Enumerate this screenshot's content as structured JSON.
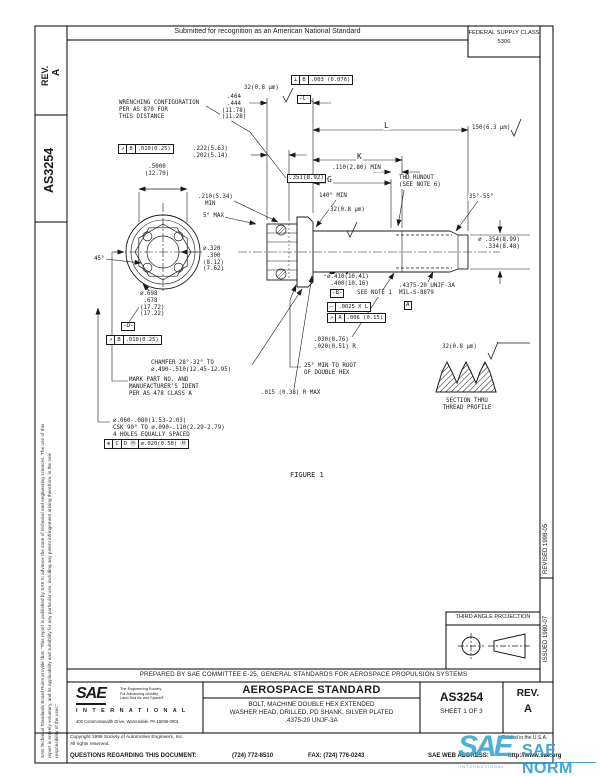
{
  "header": {
    "submitted": "Submitted for recognition as an American National Standard",
    "fsc_line1": "FEDERAL SUPPLY CLASS",
    "fsc_line2": "5306"
  },
  "side": {
    "rev_label": "REV.",
    "rev_value": "A",
    "doc_number": "AS3254",
    "issued": "ISSUED 1980-07",
    "revised": "REVISED 1998-05",
    "legal_line1": "SAE Technical Standards Board Rules provide that: \"This report is published by SAE to advance the state of technical and engineering sciences. The use of this",
    "legal_line2": "report is entirely voluntary, and its applicability and suitability for any particular use, including any patent infringement arising therefrom, is the sole",
    "legal_line3": "responsibility of the user.\""
  },
  "projection": {
    "label": "THIRD ANGLE PROJECTION"
  },
  "prepared": {
    "text": "PREPARED BY SAE COMMITTEE E-25, GENERAL STANDARDS FOR AEROSPACE PROPULSION SYSTEMS"
  },
  "titleblock": {
    "type": "AEROSPACE STANDARD",
    "title_line1": "BOLT, MACHINE DOUBLE HEX EXTENDED",
    "title_line2": "WASHER HEAD, DRILLED, PD SHANK, SILVER PLATED",
    "title_line3": ".4375-20 UNJF-3A",
    "number": "AS3254",
    "sheet": "SHEET 1 OF 3",
    "rev_label": "REV.",
    "rev_value": "A",
    "logo_text": "SAE",
    "logo_tagline": "The Engineering Society\nFor Advancing Mobility\nLand Sea Air and Space®",
    "logo_intl": "I N T E R N A T I O N A L",
    "logo_address": "400 Commonwealth Drive, Warrendale, PA 15096-0001"
  },
  "footer": {
    "copyright_line1": "Copyright 1998 Society of Automotive Engineers, Inc.",
    "copyright_line2": "All rights reserved.",
    "printed": "Printed in the U.S.A.",
    "questions_label": "QUESTIONS REGARDING THIS DOCUMENT:",
    "phone": "(724) 772-8510",
    "fax": "FAX: (724) 776-0243",
    "web_label": "SAE WEB ADDRESS:",
    "web": "http://www.sae.org"
  },
  "watermark": {
    "logo": "SAE",
    "intl": "INTERNATIONAL",
    "norm": "SAE NORM"
  },
  "colors": {
    "ink": "#1a1a1a",
    "watermark_blue": "#3ea6d8",
    "watermark_blue_dark": "#2f9dd0"
  },
  "drawing": {
    "figure_caption": "FIGURE 1",
    "labels": [
      {
        "n": "wrenching-note",
        "t": "WRENCHING CONFIGURATION\nPER AS 870 FOR\nTHIS DISTANCE",
        "x": 118,
        "y": 100
      },
      {
        "n": "finish-32-head",
        "t": "32(0.8 μm)",
        "x": 243,
        "y": 85
      },
      {
        "n": "dim-head-height",
        "t": ".464\n.444\n(11.78)\n(11.28)",
        "x": 220,
        "y": 94,
        "al": "c",
        "w": 26
      },
      {
        "n": "dim-wrench-depth",
        "t": ".222(5.63)\n.202(5.14)",
        "x": 192,
        "y": 146
      },
      {
        "n": "dim-across-flats",
        "t": ".5000\n(12.70)",
        "x": 141,
        "y": 164,
        "al": "c",
        "w": 30
      },
      {
        "n": "dim-wrench-dia",
        "t": ".351(8.92)",
        "x": 287,
        "y": 174,
        "boxed": true
      },
      {
        "n": "dim-210-min",
        "t": ".210(5.34)\n  MIN",
        "x": 197,
        "y": 194
      },
      {
        "n": "angle-5-max",
        "t": "5° MAX",
        "x": 202,
        "y": 213
      },
      {
        "n": "dim-320",
        "t": "⌀.320\n .300\n(8.12)\n(7.62)",
        "x": 202,
        "y": 246
      },
      {
        "n": "angle-45",
        "t": "45°",
        "x": 93,
        "y": 256
      },
      {
        "n": "dim-698",
        "t": "⌀.698\n .678\n(17.72)\n(17.22)",
        "x": 139,
        "y": 291
      },
      {
        "n": "chamfer-note",
        "t": "CHAMFER 28°-32° TO\n⌀.490-.510(12.45-12.95)",
        "x": 150,
        "y": 360
      },
      {
        "n": "mark-note",
        "t": "MARK PART NO. AND\nMANUFACTURER'S IDENT\nPER AS 478 CLASS A",
        "x": 128,
        "y": 377
      },
      {
        "n": "holes-note",
        "t": "⌀.060-.080(1.53-2.03)\nCSK 90° TO ⌀.090-.110(2.29-2.79)\n4 HOLES EQUALLY SPACED",
        "x": 112,
        "y": 418
      },
      {
        "n": "dim-L",
        "t": "L",
        "x": 383,
        "y": 121,
        "fs": 8
      },
      {
        "n": "finish-150",
        "t": "150(6.3 μm)",
        "x": 471,
        "y": 125
      },
      {
        "n": "dim-K",
        "t": "K",
        "x": 356,
        "y": 152,
        "fs": 8
      },
      {
        "n": "dim-110-min",
        "t": ".110(2.80) MIN",
        "x": 331,
        "y": 165
      },
      {
        "n": "dim-G",
        "t": "G",
        "x": 326,
        "y": 175,
        "fs": 8
      },
      {
        "n": "thd-runout-note",
        "t": "THD RUNOUT\n(SEE NOTE 6)",
        "x": 398,
        "y": 175
      },
      {
        "n": "angle-35-55",
        "t": "35°-55°",
        "x": 468,
        "y": 194
      },
      {
        "n": "angle-140-min",
        "t": "140° MIN",
        "x": 318,
        "y": 193
      },
      {
        "n": "finish-32-shank",
        "t": "32(0.8 μm)",
        "x": 329,
        "y": 207
      },
      {
        "n": "dim-point",
        "t": "⌀ .354(8.99)\n  .334(8.48)",
        "x": 477,
        "y": 237
      },
      {
        "n": "dim-410",
        "t": "⌀.410(10.41)\n .400(10.16)",
        "x": 326,
        "y": 274
      },
      {
        "n": "see-note-1",
        "t": "SEE NOTE 1",
        "x": 356,
        "y": 290
      },
      {
        "n": "thread-callout",
        "t": ".4375-20 UNJF-3A\nMIL-S-8879",
        "x": 398,
        "y": 283
      },
      {
        "n": "dim-030-r",
        "t": ".030(0.76)\n.020(0.51) R",
        "x": 313,
        "y": 337
      },
      {
        "n": "hex-root-note",
        "t": "25° MIN TO ROOT\nOF DOUBLE HEX",
        "x": 303,
        "y": 363
      },
      {
        "n": "radius-max-note",
        "t": ".015 (0.38) R MAX",
        "x": 260,
        "y": 390
      },
      {
        "n": "finish-32-section",
        "t": "32(0.8 μm)",
        "x": 441,
        "y": 344
      },
      {
        "n": "section-label",
        "t": "SECTION THRU\nTHREAD PROFILE",
        "x": 436,
        "y": 398,
        "al": "c",
        "w": 60
      },
      {
        "n": "figure-label",
        "t": "FIGURE 1",
        "x": 289,
        "y": 471,
        "fs": 7
      },
      {
        "n": "datum-c",
        "t": "-C-",
        "x": 297,
        "y": 95,
        "boxed": true
      },
      {
        "n": "datum-d",
        "t": "-D-",
        "x": 121,
        "y": 322,
        "boxed": true
      },
      {
        "n": "datum-b",
        "t": "-B-",
        "x": 330,
        "y": 289,
        "boxed": true
      },
      {
        "n": "datum-a",
        "t": "A",
        "x": 404,
        "y": 301,
        "boxed": true
      }
    ],
    "frames": [
      {
        "n": "fcf-perpendicularity",
        "x": 292,
        "y": 75,
        "cells": [
          "⊥",
          "B",
          ".003 (0.076)"
        ]
      },
      {
        "n": "fcf-runout-wrench",
        "x": 119,
        "y": 144,
        "cells": [
          "↗",
          "B",
          ".010(0.25)"
        ]
      },
      {
        "n": "fcf-runout-head",
        "x": 107,
        "y": 335,
        "cells": [
          "↗",
          "B",
          ".010(0.25)"
        ]
      },
      {
        "n": "fcf-position-holes",
        "x": 105,
        "y": 439,
        "cells": [
          "⊕",
          "C",
          "D Ⓜ",
          "⌀.020(0.50)  Ⓜ"
        ]
      },
      {
        "n": "fcf-straightness",
        "x": 328,
        "y": 302,
        "cells": [
          "—",
          ".0025 X L"
        ]
      },
      {
        "n": "fcf-runout-thread",
        "x": 328,
        "y": 313,
        "cells": [
          "↗",
          "A",
          ".006 (0.15)"
        ]
      }
    ]
  }
}
